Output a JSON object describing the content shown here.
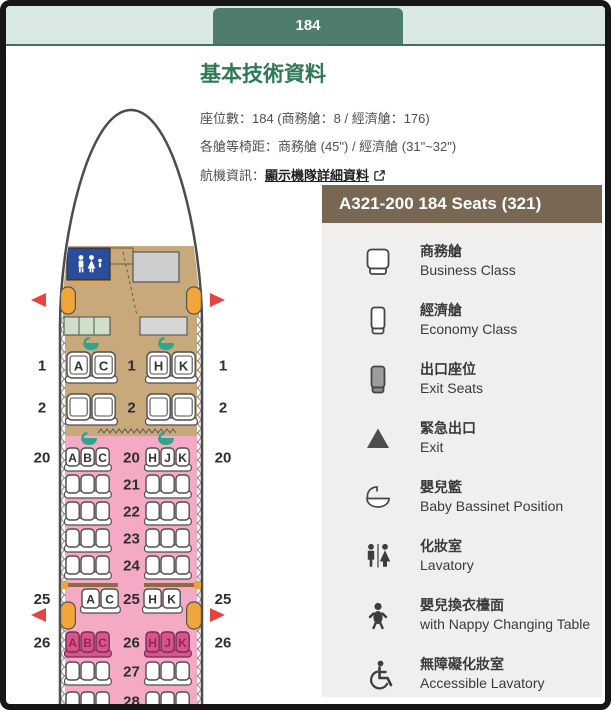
{
  "page": {
    "tab_label": "184"
  },
  "info": {
    "title": "基本技術資料",
    "seats_line": "座位數：184 (商務艙：8 / 經濟艙：176)",
    "pitch_line": "各艙等椅距：商務艙 (45\") / 經濟艙 (31\"~32\")",
    "aircraft_label": "航機資訊：",
    "aircraft_link": "顯示機隊詳細資料"
  },
  "legend": {
    "title": "A321-200 184 Seats (321)",
    "items": [
      {
        "icon": "business-seat-icon",
        "zh": "商務艙",
        "en": "Business Class"
      },
      {
        "icon": "economy-seat-icon",
        "zh": "經濟艙",
        "en": "Economy Class"
      },
      {
        "icon": "exit-seat-icon",
        "zh": "出口座位",
        "en": "Exit Seats"
      },
      {
        "icon": "exit-arrow-icon",
        "zh": "緊急出口",
        "en": "Exit"
      },
      {
        "icon": "bassinet-icon",
        "zh": "嬰兒籃",
        "en": "Baby Bassinet Position"
      },
      {
        "icon": "lavatory-icon",
        "zh": "化妝室",
        "en": "Lavatory"
      },
      {
        "icon": "nappy-icon",
        "zh": "嬰兒換衣檯面",
        "en": "with Nappy Changing Table"
      },
      {
        "icon": "accessible-lavatory-icon",
        "zh": "無障礙化妝室",
        "en": "Accessible Lavatory"
      }
    ]
  },
  "seatmap": {
    "aircraft": "A321-200",
    "rows": [
      {
        "num": "1",
        "cabin": "business",
        "config": "2-2",
        "left": [
          "A",
          "C"
        ],
        "right": [
          "H",
          "K"
        ],
        "outer_numbers": true,
        "highlight": false
      },
      {
        "num": "2",
        "cabin": "business",
        "config": "2-2",
        "left": [],
        "right": [],
        "outer_numbers": true,
        "highlight": false
      },
      {
        "num": "20",
        "cabin": "economy",
        "config": "3-3",
        "left": [
          "A",
          "B",
          "C"
        ],
        "right": [
          "H",
          "J",
          "K"
        ],
        "outer_numbers": true,
        "highlight": false
      },
      {
        "num": "21",
        "cabin": "economy",
        "config": "3-3",
        "left": [],
        "right": [],
        "outer_numbers": false,
        "highlight": false
      },
      {
        "num": "22",
        "cabin": "economy",
        "config": "3-3",
        "left": [],
        "right": [],
        "outer_numbers": false,
        "highlight": false
      },
      {
        "num": "23",
        "cabin": "economy",
        "config": "3-3",
        "left": [],
        "right": [],
        "outer_numbers": false,
        "highlight": false
      },
      {
        "num": "24",
        "cabin": "economy",
        "config": "3-3",
        "left": [],
        "right": [],
        "outer_numbers": false,
        "highlight": false
      },
      {
        "num": "25",
        "cabin": "economy",
        "config": "2-2",
        "left": [
          "A",
          "C"
        ],
        "right": [
          "H",
          "K"
        ],
        "outer_numbers": true,
        "highlight": false
      },
      {
        "num": "26",
        "cabin": "economy",
        "config": "3-3",
        "left": [
          "A",
          "B",
          "C"
        ],
        "right": [
          "H",
          "J",
          "K"
        ],
        "outer_numbers": true,
        "highlight": true
      },
      {
        "num": "27",
        "cabin": "economy",
        "config": "3-3",
        "left": [],
        "right": [],
        "outer_numbers": false,
        "highlight": false
      },
      {
        "num": "28",
        "cabin": "economy",
        "config": "3-3",
        "left": [],
        "right": [],
        "outer_numbers": false,
        "highlight": false
      }
    ]
  },
  "colors": {
    "brand_green": "#4e7d6d",
    "header_mint": "#d9e9e1",
    "title_green": "#2e7a57",
    "legend_header": "#776753",
    "legend_bg": "#f1efed",
    "business_zone": "#c8a97c",
    "economy_zone": "#f4a9c4",
    "exit_row_seat": "#d5568c",
    "door_orange": "#f2a63a",
    "exit_arrow_red": "#e74341",
    "lavatory_blue": "#2a4d9b",
    "bassinet_teal": "#2fa48f"
  }
}
